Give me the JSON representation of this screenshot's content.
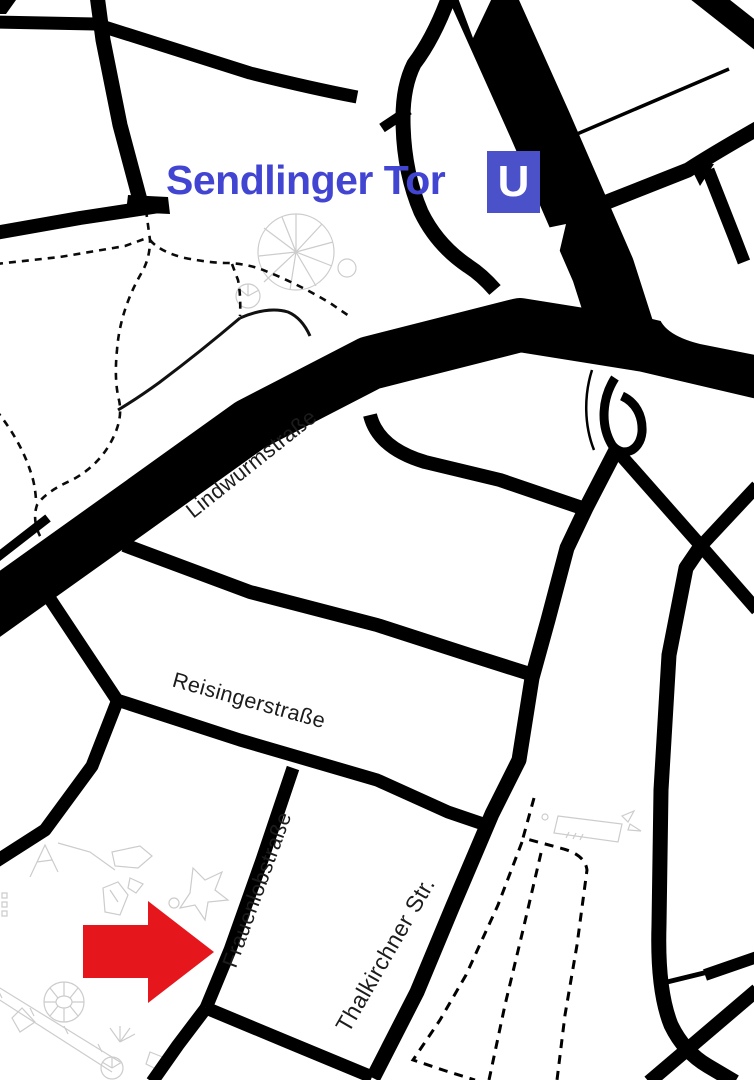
{
  "station": {
    "name": "Sendlinger Tor",
    "label_color": "#4245d1",
    "ubahn": {
      "letter": "U",
      "bg_color": "#4a51c9",
      "text_color": "#ffffff"
    }
  },
  "streets": [
    {
      "name": "Lindwurmstraße"
    },
    {
      "name": "Reisingerstraße"
    },
    {
      "name": "Frauenlobstraße"
    },
    {
      "name": "Thalkirchner Str."
    }
  ],
  "marker": {
    "shape": "arrow-right",
    "color": "#e6161d",
    "points_at": "Frauenlobstraße"
  },
  "map": {
    "background": "#ffffff",
    "road_color": "#000000",
    "sketch_color": "#cccccc",
    "street_label_color": "#1c1c1c"
  }
}
